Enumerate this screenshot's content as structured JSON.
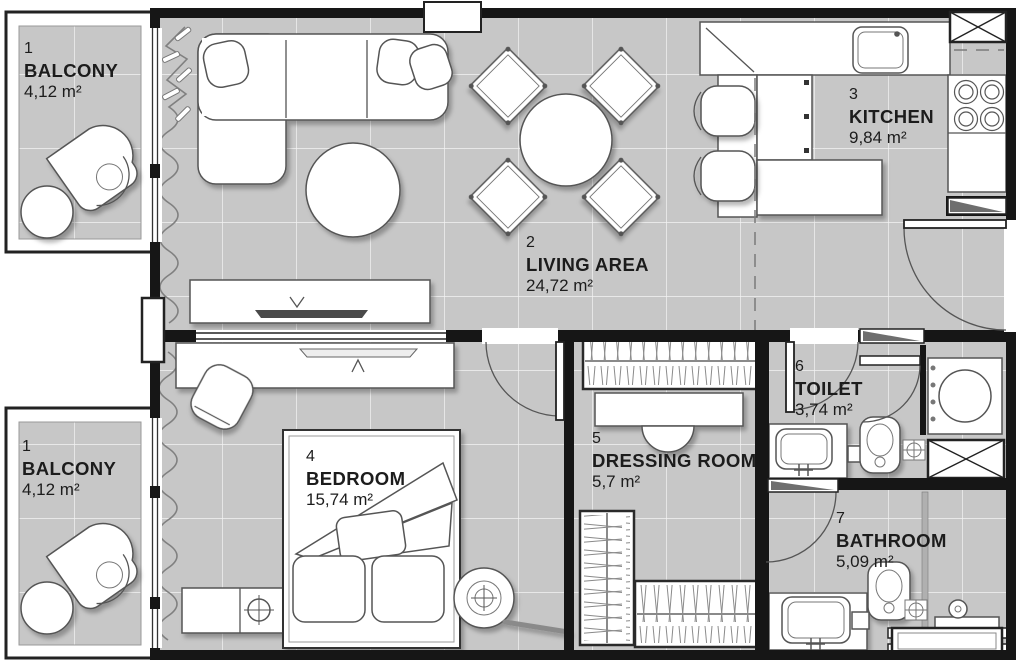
{
  "plan": {
    "type": "apartment-floor-plan",
    "rooms": {
      "balcony_top": {
        "number": "1",
        "name": "BALCONY",
        "area": "4,12 m²"
      },
      "living": {
        "number": "2",
        "name": "LIVING AREA",
        "area": "24,72 m²"
      },
      "kitchen": {
        "number": "3",
        "name": "KITCHEN",
        "area": "9,84 m²"
      },
      "bedroom": {
        "number": "4",
        "name": "BEDROOM",
        "area": "15,74 m²"
      },
      "dressing": {
        "number": "5",
        "name": "DRESSING ROOM",
        "area": "5,7 m²"
      },
      "toilet": {
        "number": "6",
        "name": "TOILET",
        "area": "3,74 m²"
      },
      "bathroom": {
        "number": "7",
        "name": "BATHROOM",
        "area": "5,09 m²"
      },
      "balcony_bottom": {
        "number": "1",
        "name": "BALCONY",
        "area": "4,12 m²"
      }
    },
    "colors": {
      "floor": "#c7c7c7",
      "grid_line": "#f4f4f4",
      "wall": "#161616",
      "furniture_fill": "#ffffff",
      "furniture_line": "#555555",
      "label_text": "#1c1c1c"
    }
  }
}
